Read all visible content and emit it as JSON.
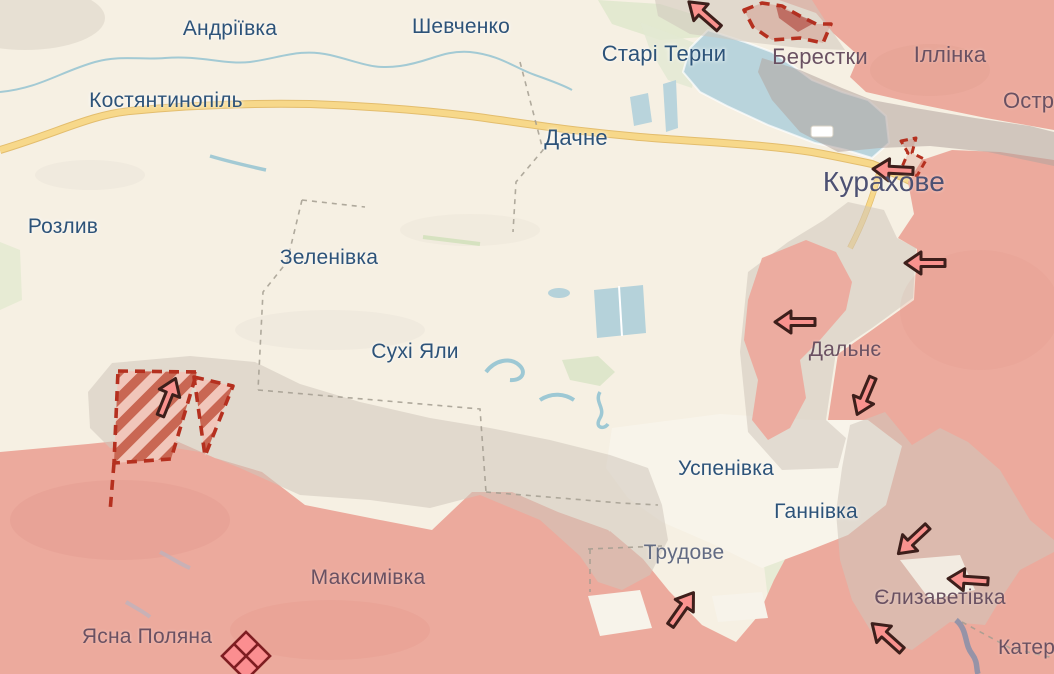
{
  "map": {
    "region_labels": [
      {
        "text": "Андріївка",
        "x": 230,
        "y": 29,
        "size": 21,
        "tone": "blue"
      },
      {
        "text": "Шевченко",
        "x": 461,
        "y": 27,
        "size": 21,
        "tone": "blue"
      },
      {
        "text": "Костянтинопіль",
        "x": 166,
        "y": 101,
        "size": 21,
        "tone": "blue"
      },
      {
        "text": "Старі Терни",
        "x": 664,
        "y": 54,
        "size": 22,
        "tone": "blue"
      },
      {
        "text": "Берестки",
        "x": 820,
        "y": 57,
        "size": 22,
        "tone": "muted"
      },
      {
        "text": "Іллінка",
        "x": 950,
        "y": 55,
        "size": 22,
        "tone": "muted"
      },
      {
        "text": "Остр",
        "x": 1003,
        "y": 101,
        "size": 22,
        "tone": "muted",
        "align": "left"
      },
      {
        "text": "Дачне",
        "x": 576,
        "y": 138,
        "size": 22,
        "tone": "blue"
      },
      {
        "text": "Курахове",
        "x": 884,
        "y": 182,
        "size": 28,
        "tone": "city"
      },
      {
        "text": "Розлив",
        "x": 63,
        "y": 227,
        "size": 21,
        "tone": "blue"
      },
      {
        "text": "Зеленівка",
        "x": 329,
        "y": 258,
        "size": 21,
        "tone": "blue"
      },
      {
        "text": "Сухі Яли",
        "x": 415,
        "y": 352,
        "size": 21,
        "tone": "blue"
      },
      {
        "text": "Дальнє",
        "x": 845,
        "y": 350,
        "size": 21,
        "tone": "muted"
      },
      {
        "text": "Успенівка",
        "x": 726,
        "y": 469,
        "size": 21,
        "tone": "blue"
      },
      {
        "text": "Ганнівка",
        "x": 816,
        "y": 512,
        "size": 21,
        "tone": "blue"
      },
      {
        "text": "Трудове",
        "x": 684,
        "y": 553,
        "size": 21,
        "tone": "slate"
      },
      {
        "text": "Максимівка",
        "x": 368,
        "y": 578,
        "size": 21,
        "tone": "muted"
      },
      {
        "text": "Ясна Поляна",
        "x": 147,
        "y": 637,
        "size": 21,
        "tone": "muted"
      },
      {
        "text": "Єлизаветівка",
        "x": 940,
        "y": 598,
        "size": 21,
        "tone": "muted"
      },
      {
        "text": "Катер",
        "x": 998,
        "y": 648,
        "size": 21,
        "tone": "muted",
        "align": "left"
      }
    ],
    "arrows": [
      {
        "x": 704,
        "y": 15,
        "angle": -139
      },
      {
        "x": 893,
        "y": 170,
        "angle": 183
      },
      {
        "x": 925,
        "y": 263,
        "angle": 180
      },
      {
        "x": 795,
        "y": 322,
        "angle": 180
      },
      {
        "x": 865,
        "y": 396,
        "angle": 113
      },
      {
        "x": 913,
        "y": 540,
        "angle": 137
      },
      {
        "x": 968,
        "y": 580,
        "angle": 184
      },
      {
        "x": 887,
        "y": 637,
        "angle": -138
      },
      {
        "x": 682,
        "y": 609,
        "angle": -55
      },
      {
        "x": 168,
        "y": 397,
        "angle": -68
      }
    ],
    "markers": {
      "diamond": {
        "x": 246,
        "y": 656
      }
    },
    "colors": {
      "base_land": "#f6f0e3",
      "occupied_pink": "#ecaa9d",
      "grey_zone": "#cfc6bb",
      "water": "#b9d4dc",
      "road": "#f7d88a",
      "advance_dash_red": "#b5301f",
      "arrow_fill": "#f9928e",
      "label_blue": "#2d5379"
    }
  }
}
